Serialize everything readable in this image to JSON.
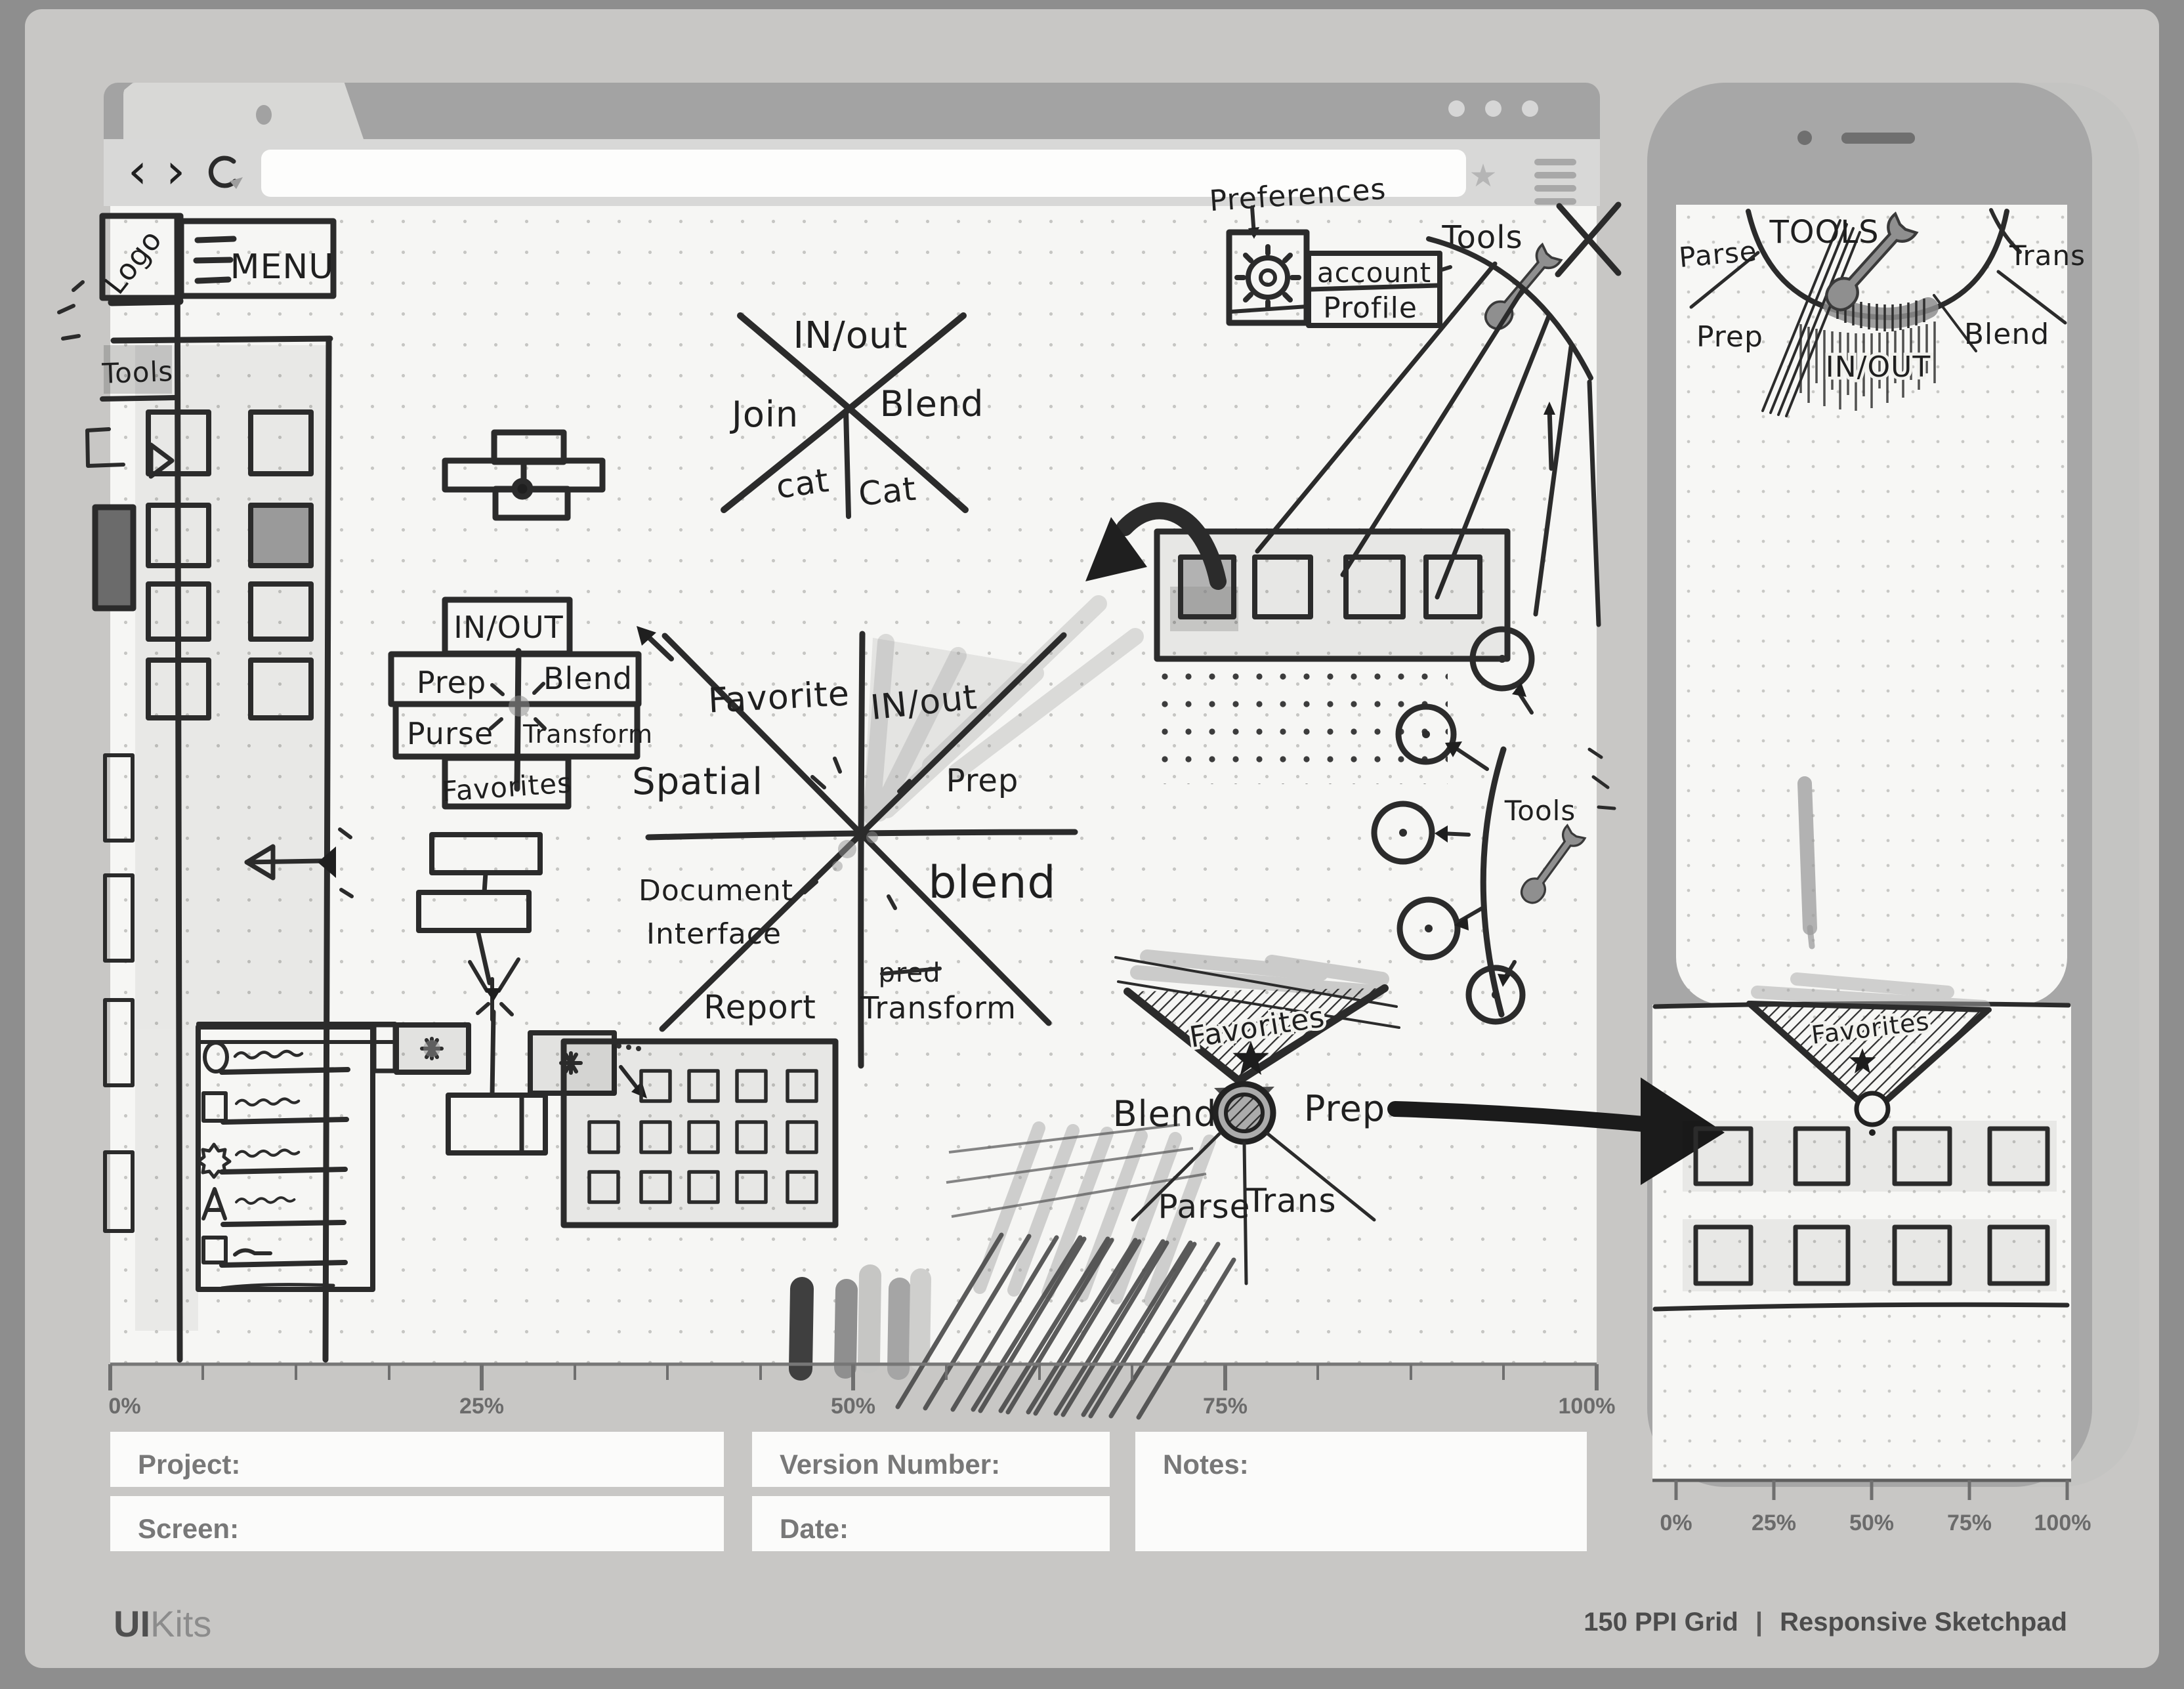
{
  "chrome": {
    "icons": {
      "back": "‹",
      "forward": "›",
      "star": "★",
      "menu": "≡"
    }
  },
  "rulers": {
    "browser": [
      "0%",
      "25%",
      "50%",
      "75%",
      "100%"
    ],
    "phone": [
      "0%",
      "25%",
      "50%",
      "75%",
      "100%"
    ]
  },
  "form": {
    "project_label": "Project:",
    "screen_label": "Screen:",
    "version_label": "Version Number:",
    "date_label": "Date:",
    "notes_label": "Notes:"
  },
  "footer": {
    "brand_bold": "UI",
    "brand_light": "Kits",
    "right_grid": "150 PPI Grid",
    "right_sep": "|",
    "right_name": "Responsive Sketchpad"
  },
  "sketch": {
    "logo": "Logo",
    "menu": "MENU",
    "sidebar_tools": "Tools",
    "xdiagram": {
      "top": "IN/out",
      "left": "Join",
      "right": "Blend",
      "bottom_left": "cat",
      "bottom_right": "Cat"
    },
    "stack": {
      "top": "IN/OUT",
      "mid_left": "Prep",
      "mid_right": "Blend",
      "low_left": "Purse",
      "low_right": "Transform",
      "bottom": "Favorites"
    },
    "star8": {
      "nw": "Favorite",
      "ne": "IN/out",
      "w": "Spatial",
      "e": "Prep",
      "sw_line1": "Document",
      "sw_line2": "Interface",
      "se": "blend",
      "s": "Report",
      "struck": "pred",
      "s_label": "Transform"
    },
    "prefs": {
      "title": "Preferences",
      "row1": "account",
      "row2": "Profile",
      "tools": "Tools"
    },
    "wheel": {
      "tools": "Tools"
    },
    "fan": {
      "title": "Favorites",
      "left": "Blend",
      "right": "Prep",
      "bottom_left": "Parse",
      "bottom_right": "Trans"
    }
  },
  "phone_sketch": {
    "arc": {
      "tools": "TOOLS",
      "left": "Parse",
      "right": "Trans",
      "bottom_left": "Prep",
      "bottom_right": "Blend",
      "center": "IN/OUT"
    },
    "band": {
      "title": "Favorites"
    }
  }
}
